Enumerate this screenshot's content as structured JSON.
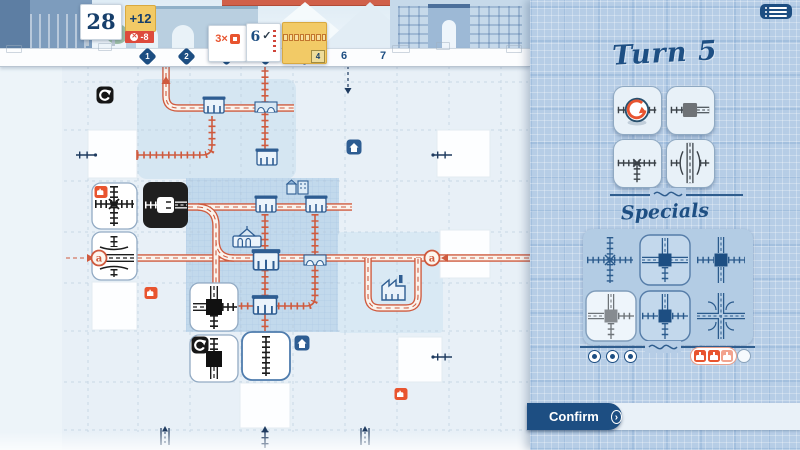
{
  "header": {
    "score": "28",
    "score_bonus": "+12",
    "score_penalty": "-8",
    "card_multiplier": "3×",
    "card_check_value": "6",
    "check_mark": "✓",
    "current_turn_badge": "4",
    "turns": [
      "1",
      "2",
      "3",
      "4",
      "5",
      "6",
      "7"
    ],
    "current_turn": 5,
    "menu_icon": "hamburger-menu-icon"
  },
  "board": {
    "exit_left_label": "a",
    "exit_right_label": "a",
    "edge_exits": [
      {
        "side": "top",
        "kind": "road",
        "connected": true
      },
      {
        "side": "top",
        "kind": "road",
        "connected": false
      },
      {
        "side": "left",
        "kind": "rail"
      },
      {
        "side": "left",
        "kind": "road-a"
      },
      {
        "side": "right",
        "kind": "road-a"
      },
      {
        "side": "bottom",
        "kind": "road"
      },
      {
        "side": "bottom",
        "kind": "rail"
      },
      {
        "side": "bottom",
        "kind": "road"
      }
    ],
    "placed_ink_tiles": [
      {
        "type": "rail-cross-x",
        "badge": "train-badge"
      },
      {
        "type": "road-overpass-over-rail"
      },
      {
        "type": "black-station-rail-road"
      },
      {
        "type": "station-roads-to-rails"
      },
      {
        "type": "station-rail-to-road",
        "badge": "rotate-icon"
      },
      {
        "type": "rail-straight-vertical",
        "state": "selected"
      }
    ],
    "markers": {
      "train_badges": 3,
      "house_icons": 2,
      "rotate_icons": 2
    }
  },
  "panel": {
    "title": "Turn 5",
    "specials_title": "Specials",
    "confirm_label": "Confirm",
    "confirm_arrow": "›",
    "dice": [
      {
        "name": "rail-straight-reroll"
      },
      {
        "name": "station-rail-to-road"
      },
      {
        "name": "rail-tee-cross"
      },
      {
        "name": "road-overpass-over-rail"
      }
    ],
    "specials": [
      {
        "name": "rail-cross"
      },
      {
        "name": "station-roads-with-rail-south"
      },
      {
        "name": "station-roads-vertical-rails-horizontal"
      },
      {
        "name": "station-used-gray"
      },
      {
        "name": "station-road-north-rails"
      },
      {
        "name": "road-cross"
      }
    ],
    "used_special_dots": 3,
    "stamps": [
      "train",
      "train",
      "train-faded",
      "empty"
    ]
  },
  "colors": {
    "navy": "#1d4e82",
    "accent_orange": "#cf5a3e",
    "badge_orange": "#e8542f",
    "yellow": "#f2ca66",
    "red": "#dd4a3c",
    "ink": "#1c1c1c"
  }
}
